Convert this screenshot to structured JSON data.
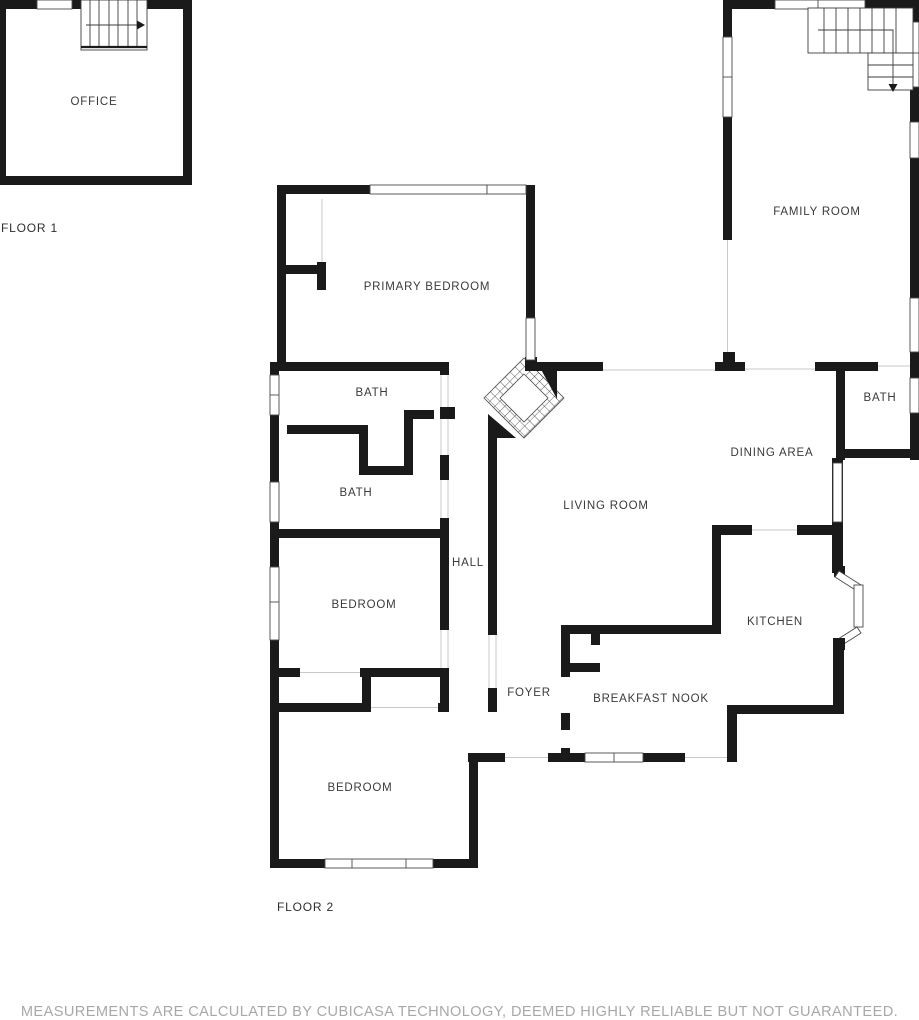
{
  "document": {
    "type": "floor-plan",
    "provider_note": "MEASUREMENTS ARE CALCULATED BY CUBICASA TECHNOLOGY, DEEMED HIGHLY RELIABLE BUT NOT GUARANTEED."
  },
  "colors": {
    "wall": "#1a1a1a",
    "room_label": "#3a3a3a",
    "disclaimer_text": "#a8a8a8",
    "opening_line": "#c9c9c9",
    "background": "#ffffff"
  },
  "floor1": {
    "label": "FLOOR 1",
    "rooms": {
      "office": "OFFICE"
    },
    "features": {
      "stairs": "stairs-up-arrow"
    }
  },
  "floor2": {
    "label": "FLOOR 2",
    "rooms": {
      "primary_bedroom": "PRIMARY BEDROOM",
      "family_room": "FAMILY ROOM",
      "bath_upper": "BATH",
      "bath_lower": "BATH",
      "bath_right": "BATH",
      "dining_area": "DINING AREA",
      "living_room": "LIVING ROOM",
      "hall": "HALL",
      "bedroom_middle": "BEDROOM",
      "bedroom_bottom": "BEDROOM",
      "kitchen": "KITCHEN",
      "breakfast_nook": "BREAKFAST NOOK",
      "foyer": "FOYER"
    },
    "features": {
      "stairs": "stairs-down-arrow",
      "fireplace": "corner-fireplace"
    }
  }
}
